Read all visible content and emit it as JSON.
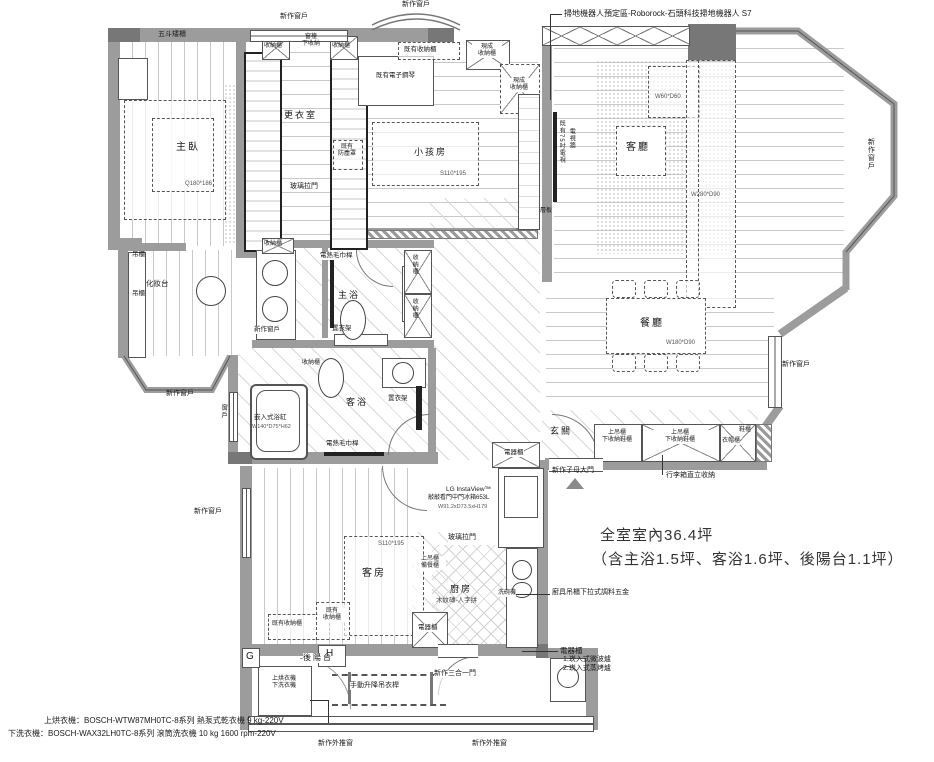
{
  "summary": {
    "line1": "全室室內36.4坪",
    "line2": "（含主浴1.5坪、客浴1.6坪、後陽台1.1坪）"
  },
  "annotations": {
    "robot_vacuum": "掃地機器人預定區-Roborock-石頭科技掃地機器人 S7",
    "dryer_spec": "上烘衣機：BOSCH-WTW87MH0TC-8系列 熱泵式乾衣機 9 kg-220V",
    "washer_spec": "下洗衣機：BOSCH-WAX32LH0TC-8系列 滾筒洗衣機 10 kg 1600 rpm-220V",
    "appliance_cabinet_title": "電器櫃",
    "appliance_cabinet_item1": "1.崁入式微波爐",
    "appliance_cabinet_item2": "2.崁入式蒸烤爐",
    "kitchen_hardware": "廚具吊櫃下拉式調料五金",
    "luggage_storage": "行李箱直立收納",
    "fridge_line1": "LG InstaView™",
    "fridge_line2": "敲敲看門中門冰箱653L",
    "fridge_line3": "W91.2xD73.5xH179"
  },
  "rooms": {
    "master_bedroom": "主臥",
    "closet": "更衣室",
    "kids_room": "小孩房",
    "living_room": "客廳",
    "dining_room": "餐廳",
    "entry": "玄關",
    "master_bath": "主浴",
    "guest_bath": "客浴",
    "guest_room": "客房",
    "kitchen": "廚房",
    "balcony": "後陽台",
    "vanity": "化妝台"
  },
  "furniture": {
    "master_bed": "Q180*186",
    "kids_bed": "S110*195",
    "guest_bed": "S110*195",
    "coffee_table": "W60*D60",
    "sofa": "W280*D90",
    "dining_table": "W180*D90",
    "tub_name": "嵌入式浴缸",
    "tub_size": "W140*D75*H62",
    "kitchen_floor": "木紋磚-人字拼"
  },
  "labels": {
    "new_window": "新作窗戶",
    "window": "窗戶",
    "push_out_window": "新作外推窗",
    "three_in_one_door": "新作三合一門",
    "double_entry_door": "新作子母大門",
    "glass_sliding_door": "玻璃拉門",
    "five_drawer_cabinet": "五斗矮櫃",
    "sill_line1": "窗檯",
    "sill_line2": "下收納",
    "storage_cabinet": "收納櫃",
    "existing_storage": "既有收納櫃",
    "existing": "既有",
    "dust_cover": "防塵罩",
    "existing_piano": "既有電子鋼琴",
    "ready_line1": "現成",
    "ready_line2": "收納櫃",
    "tv_wall": "電視牆",
    "existing_tv": "既有75吋電視",
    "shelf": "層板",
    "hanging_cabinet": "吊櫃",
    "towel_bar": "電熱毛巾桿",
    "clothes_rack": "置衣架",
    "upper_cabinet": "上吊櫃",
    "shoe_storage": "下收納鞋櫃",
    "coat_cabinet": "衣帽櫃",
    "shoe_cabinet": "鞋櫃",
    "appliance_cabinet": "電器櫃",
    "prep_cabinet": "備餐櫃",
    "dishwasher": "洗碗機",
    "dryer": "上烘衣機",
    "washer": "下洗衣機",
    "lift_rod": "手動升降吊衣桿",
    "grid_g": "G",
    "grid_h": "H"
  }
}
